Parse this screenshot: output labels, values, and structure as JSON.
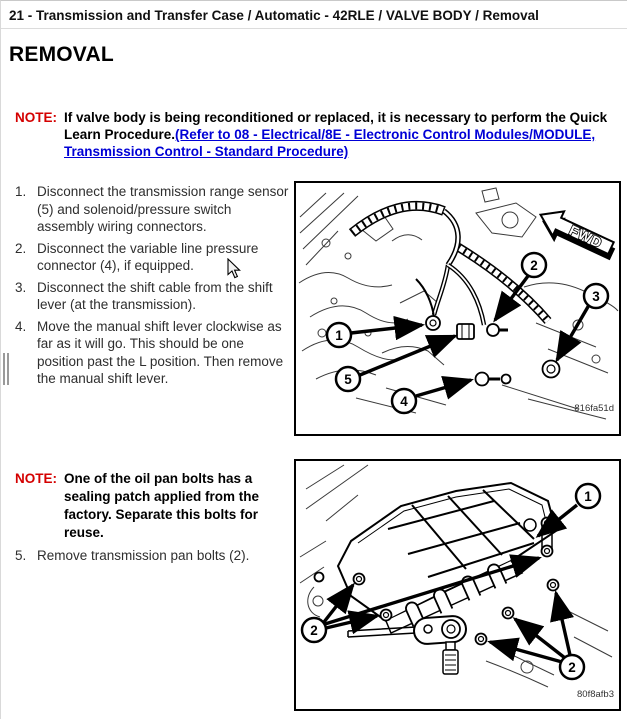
{
  "page": {
    "breadcrumb": "21 - Transmission and Transfer Case / Automatic - 42RLE / VALVE BODY / Removal",
    "heading": "REMOVAL"
  },
  "note1": {
    "label": "NOTE:",
    "text": "If valve body is being reconditioned or replaced, it is necessary to perform the Quick Learn Procedure.",
    "link": "(Refer to 08 - Electrical/8E - Electronic Control Modules/MODULE, Transmission Control - Standard Procedure)"
  },
  "steps": [
    {
      "num": "1.",
      "text": "Disconnect the transmission range sensor (5) and solenoid/pressure switch assembly wiring connectors."
    },
    {
      "num": "2.",
      "text": "Disconnect the variable line pressure connector (4), if equipped."
    },
    {
      "num": "3.",
      "text": "Disconnect the shift cable from the shift lever (at the transmission)."
    },
    {
      "num": "4.",
      "text": "Move the manual shift lever clockwise as far as it will go. This should be one position past the L position. Then remove the manual shift lever."
    }
  ],
  "note2": {
    "label": "NOTE:",
    "text": "One of the oil pan bolts has a sealing patch applied from the factory. Separate this bolts for reuse."
  },
  "step5": {
    "num": "5.",
    "text": "Remove transmission pan bolts (2)."
  },
  "figure1": {
    "code": "816fa51d",
    "fwd_label": "FWD",
    "callouts": [
      "1",
      "2",
      "3",
      "4",
      "5"
    ]
  },
  "figure2": {
    "code": "80f8afb3",
    "callouts": [
      "1",
      "2",
      "2"
    ]
  },
  "colors": {
    "note_label": "#d40000",
    "link": "#0000d6",
    "line_art": "#000000"
  }
}
